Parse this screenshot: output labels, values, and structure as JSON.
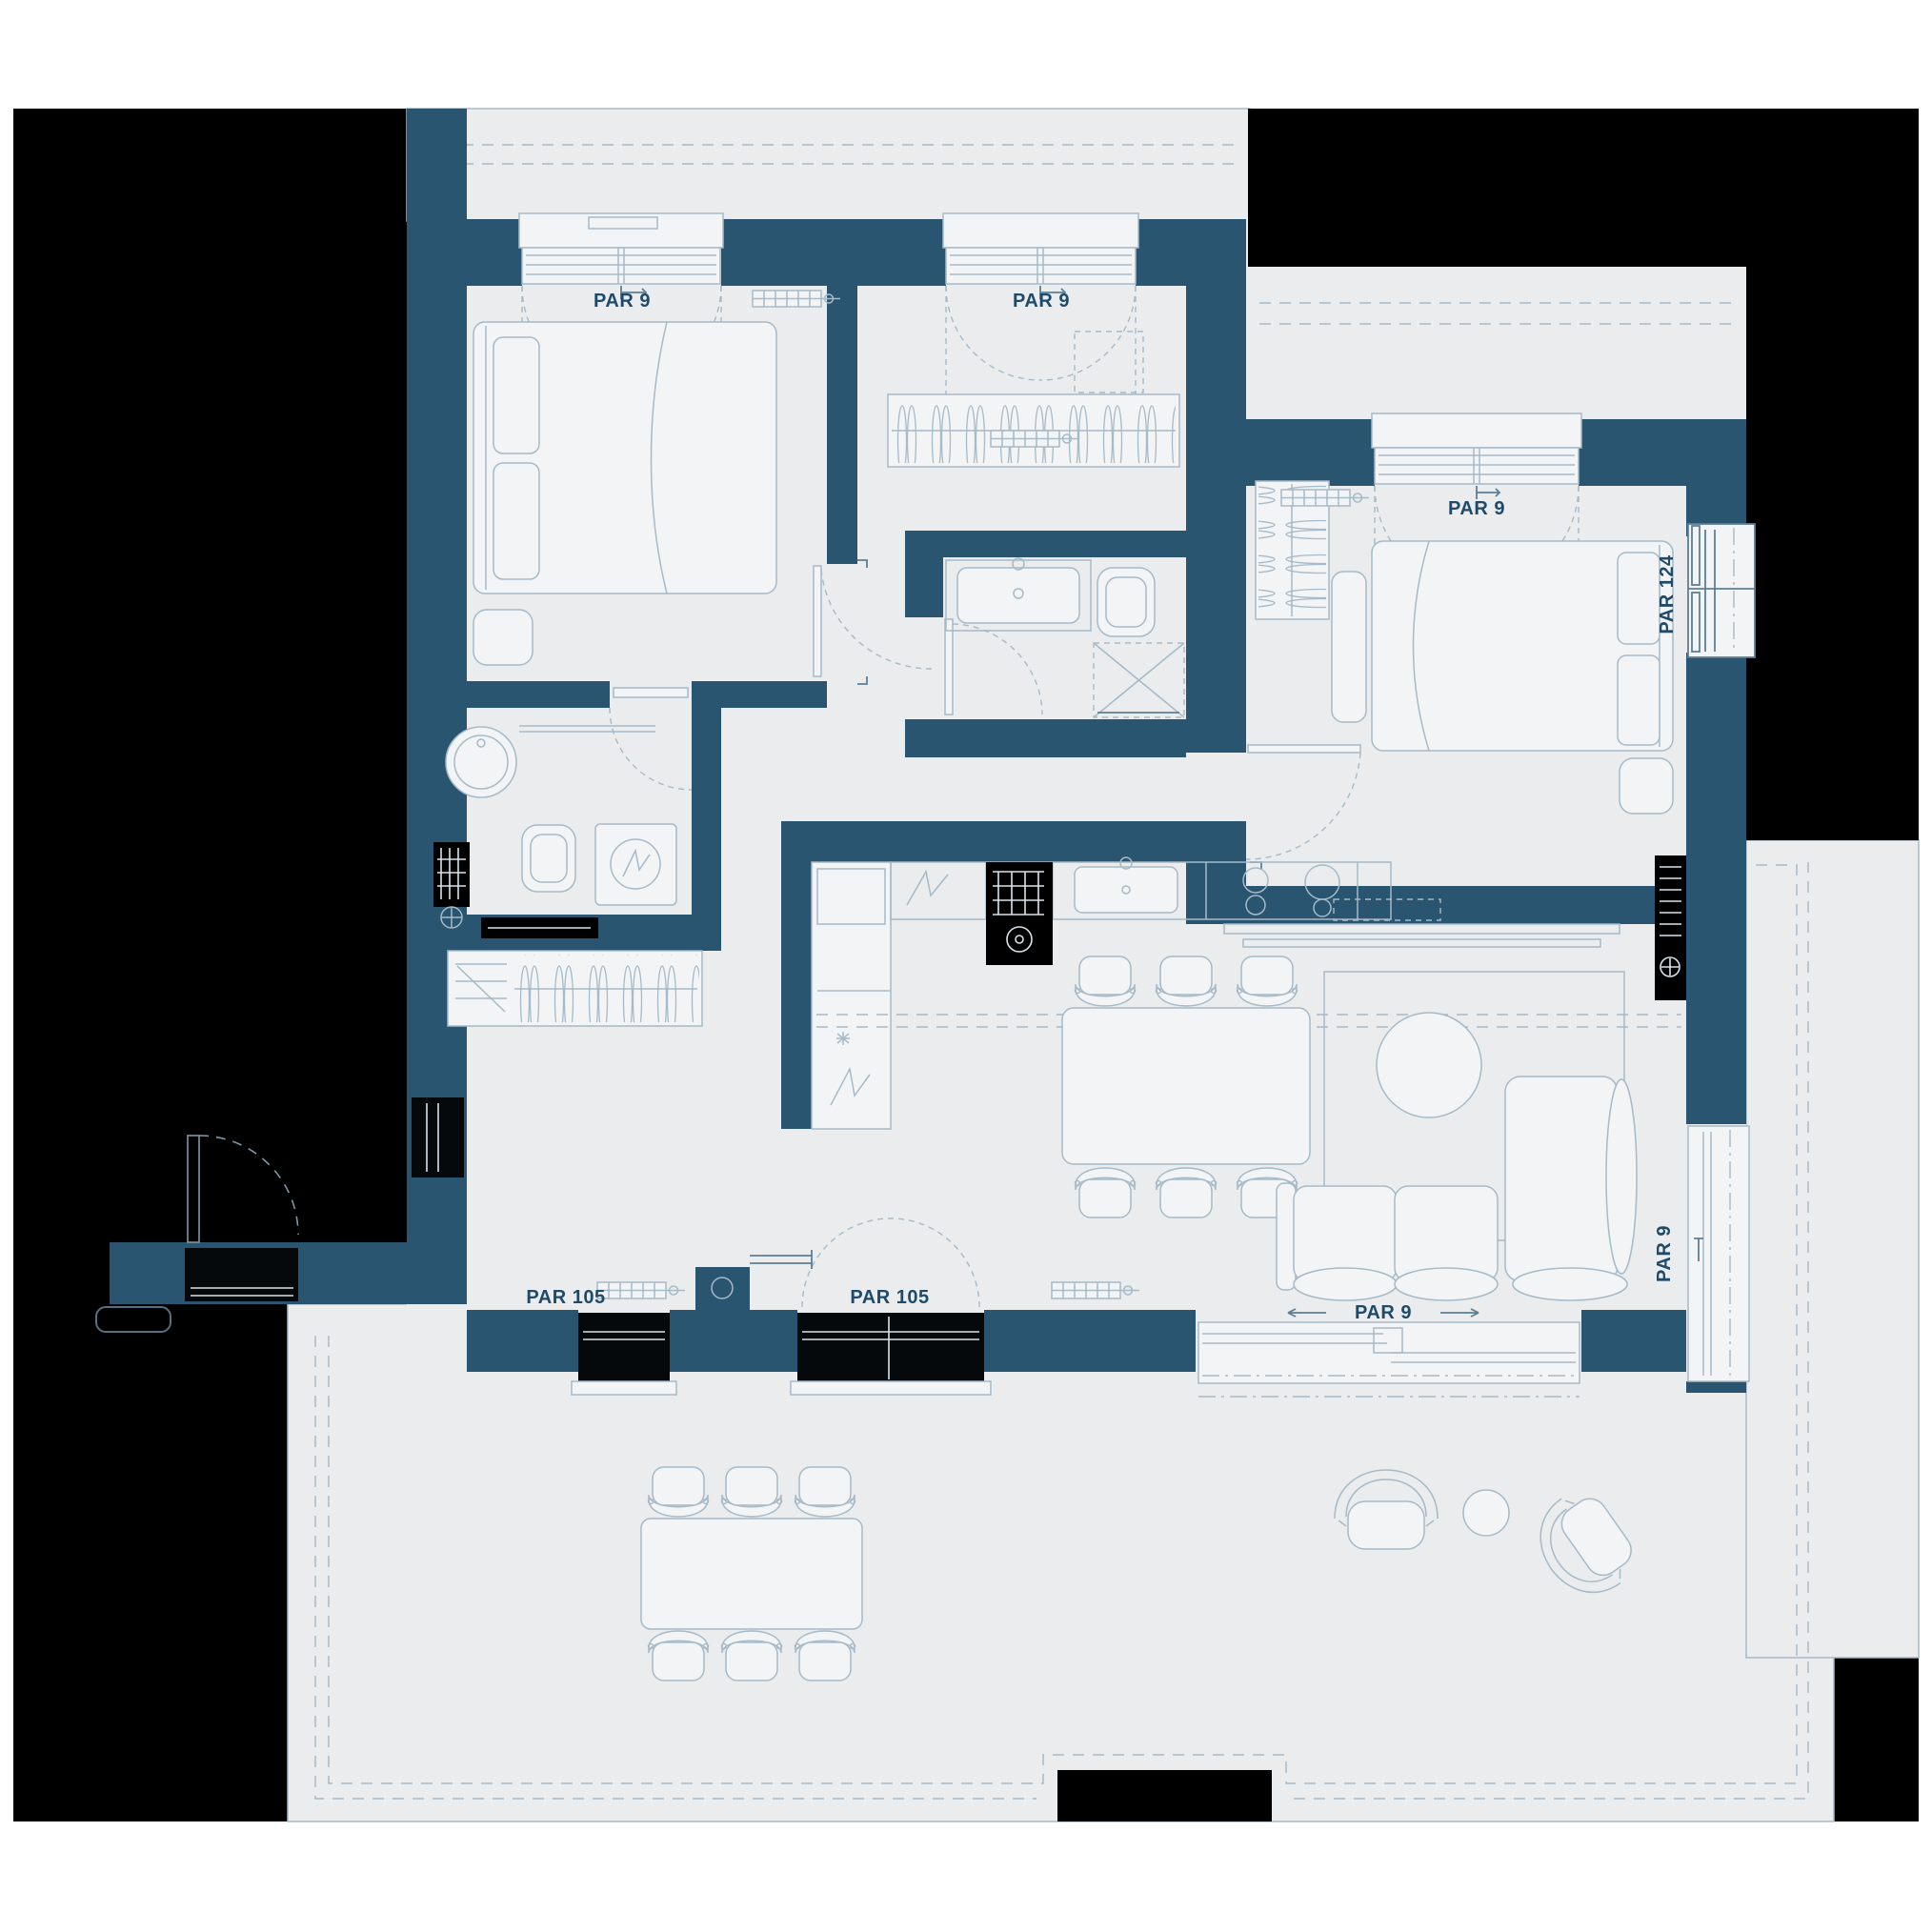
{
  "plan": {
    "type": "apartment-floor-plan",
    "labels": {
      "window_top_left": "PAR 9",
      "window_top_center": "PAR 9",
      "window_bedroom_right": "PAR 9",
      "window_right_side": "PAR 124",
      "window_living_side": "PAR 9",
      "window_living_bottom": "PAR 9",
      "window_hall_bottom_left": "PAR 105",
      "window_hall_bottom_center": "PAR 105"
    }
  },
  "colors": {
    "page": "#FFFFFF",
    "outside": "#000000",
    "wall": "#2A5571",
    "floor": "#EAECED",
    "furniture": "#F3F4F5",
    "line": "#A6BAC7",
    "line_strong": "#5E7F95",
    "glyph_light": "#D9E3EA",
    "label_text": "#1E4A6B"
  }
}
